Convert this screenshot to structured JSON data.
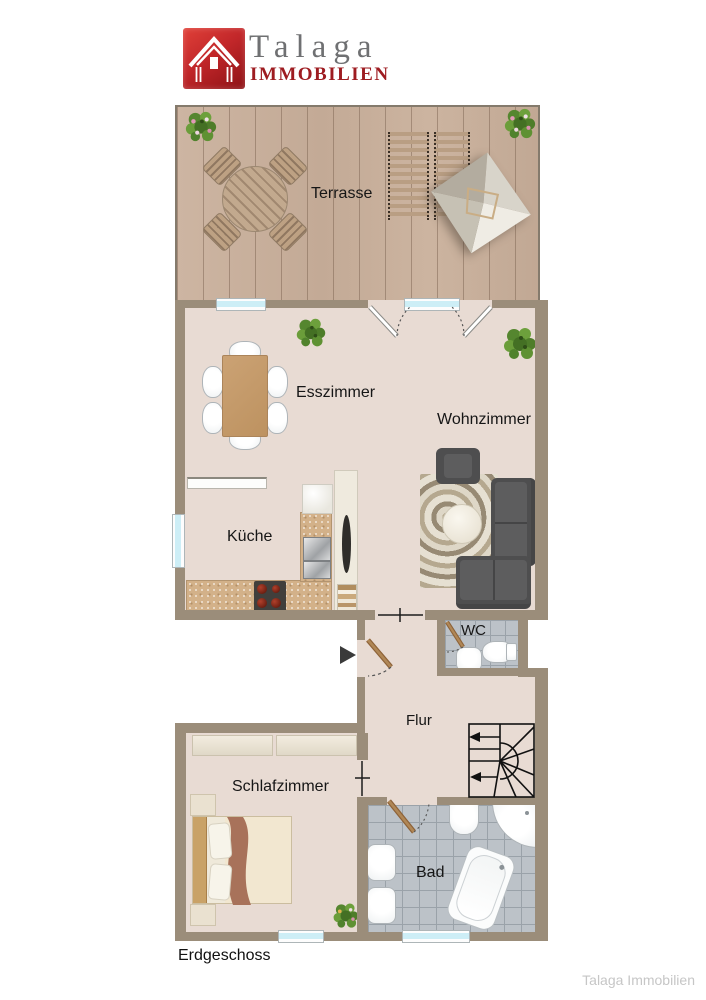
{
  "brand": {
    "name": "Talaga",
    "type": "IMMOBILIEN"
  },
  "rooms": {
    "terrasse": "Terrasse",
    "esszimmer": "Esszimmer",
    "wohnzimmer": "Wohnzimmer",
    "kueche": "Küche",
    "wc": "WC",
    "flur": "Flur",
    "schlafzimmer": "Schlafzimmer",
    "bad": "Bad"
  },
  "footer": {
    "floor": "Erdgeschoss",
    "watermark": "Talaga Immobilien"
  },
  "colors": {
    "wall": "#9b8d7a",
    "floor": "#e8dbd3",
    "window": "#cdeef6",
    "tile": "#bcc2c8",
    "tile_line": "#9aa2a9",
    "brand_red": "#c2272a",
    "logo_text": "#6f7072",
    "logo_sub": "#9e1c21",
    "door_brown": "#a5794e",
    "watermark": "#c6c6c6"
  }
}
